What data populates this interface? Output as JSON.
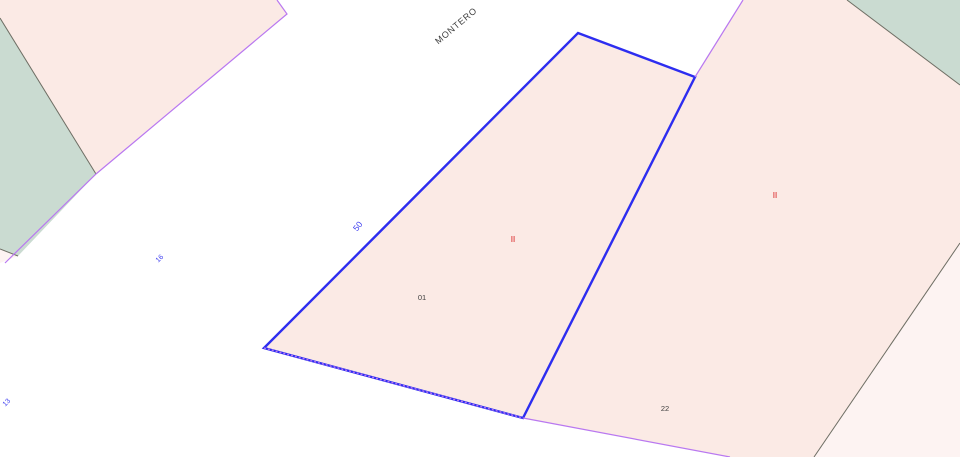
{
  "canvas": {
    "width": 960,
    "height": 457,
    "background": "#ffffff"
  },
  "palette": {
    "parcel_pink": "#fbeae5",
    "parcel_pink_light": "#fdf3f2",
    "rustic_green": "#cadbd1",
    "border_gray": "#6e6e64",
    "street_violet": "#b978f0",
    "selection_blue": "#2d2df0",
    "number_blue": "#3c3cf0",
    "floors_red": "#e45f5f",
    "label_gray": "#3f3f3f"
  },
  "parcels": [
    {
      "id": "parcel-top-left",
      "points": "0,0 277,0 287,14 96,174 0,19",
      "fill": "parcel_pink",
      "interactable": true
    },
    {
      "id": "green-area-top-left",
      "points": "0,18 96,174 18,256 0,249",
      "fill": "rustic_green",
      "interactable": true
    },
    {
      "id": "parcel-sliver-left",
      "points": "0,249 18,256 0,263",
      "fill": "parcel_pink_light",
      "interactable": true
    },
    {
      "id": "parcel-right",
      "points": "695,77 743,0 847,0 960,85 960,243 814,457 730,457 523,418",
      "fill": "parcel_pink",
      "interactable": true
    },
    {
      "id": "green-area-top-right",
      "points": "847,0 960,0 960,85",
      "fill": "rustic_green",
      "interactable": true
    },
    {
      "id": "parcel-bottom-right",
      "points": "960,243 960,457 814,457",
      "fill": "parcel_pink_light",
      "interactable": true
    },
    {
      "id": "parcel-selected",
      "points": "578,33 695,77 523,418 264,348",
      "fill": "parcel_pink",
      "interactable": true
    }
  ],
  "selection": {
    "id": "selected-parcel-outline",
    "points": "578,33 695,77 523,418 264,348",
    "stroke": "selection_blue",
    "width": 2.4
  },
  "borders": [
    {
      "id": "green-top-left-border",
      "points": "0,18 96,174",
      "stroke": "border_gray",
      "width": 1
    },
    {
      "id": "sliver-left-border",
      "points": "0,249 18,256",
      "stroke": "border_gray",
      "width": 1
    },
    {
      "id": "street-line-top-left",
      "points": "277,0 287,14 96,174 5,263",
      "stroke": "street_violet",
      "width": 1.2
    },
    {
      "id": "right-parcel-top-edge",
      "points": "743,0 695,77",
      "stroke": "street_violet",
      "width": 1.2
    },
    {
      "id": "right-parcel-bottom-edge",
      "points": "523,418 730,457",
      "stroke": "street_violet",
      "width": 1.2
    },
    {
      "id": "green-top-right-border",
      "points": "847,0 960,85",
      "stroke": "border_gray",
      "width": 1
    },
    {
      "id": "right-parcel-right-border",
      "points": "960,243 814,457",
      "stroke": "border_gray",
      "width": 1
    },
    {
      "id": "selected-bottom-street-edge",
      "points": "264,348 523,418",
      "stroke": "street_violet",
      "width": 1.4,
      "dash": "2,2"
    }
  ],
  "labels": [
    {
      "id": "street-name",
      "text": "MONTERO",
      "x": 458,
      "y": 28,
      "rotation": -40,
      "color": "label_gray",
      "size": 9,
      "spacing": 0.8
    },
    {
      "id": "street-number-50",
      "text": "50",
      "x": 360,
      "y": 228,
      "rotation": -52,
      "color": "number_blue",
      "size": 8.5
    },
    {
      "id": "street-number-16",
      "text": "16",
      "x": 161,
      "y": 260,
      "rotation": -45,
      "color": "number_blue",
      "size": 7
    },
    {
      "id": "street-number-13",
      "text": "13",
      "x": 8,
      "y": 404,
      "rotation": -45,
      "color": "number_blue",
      "size": 7
    },
    {
      "id": "parcel-number-01",
      "text": "01",
      "x": 422,
      "y": 300,
      "rotation": 0,
      "color": "label_gray",
      "size": 7.5
    },
    {
      "id": "floors-ii-selected",
      "text": "II",
      "x": 513,
      "y": 242,
      "rotation": 0,
      "color": "floors_red",
      "size": 8,
      "bold": true
    },
    {
      "id": "floors-ii-right",
      "text": "II",
      "x": 775,
      "y": 198,
      "rotation": 0,
      "color": "floors_red",
      "size": 8,
      "bold": true
    },
    {
      "id": "parcel-number-22",
      "text": "22",
      "x": 665,
      "y": 411,
      "rotation": 0,
      "color": "label_gray",
      "size": 7.5
    }
  ]
}
